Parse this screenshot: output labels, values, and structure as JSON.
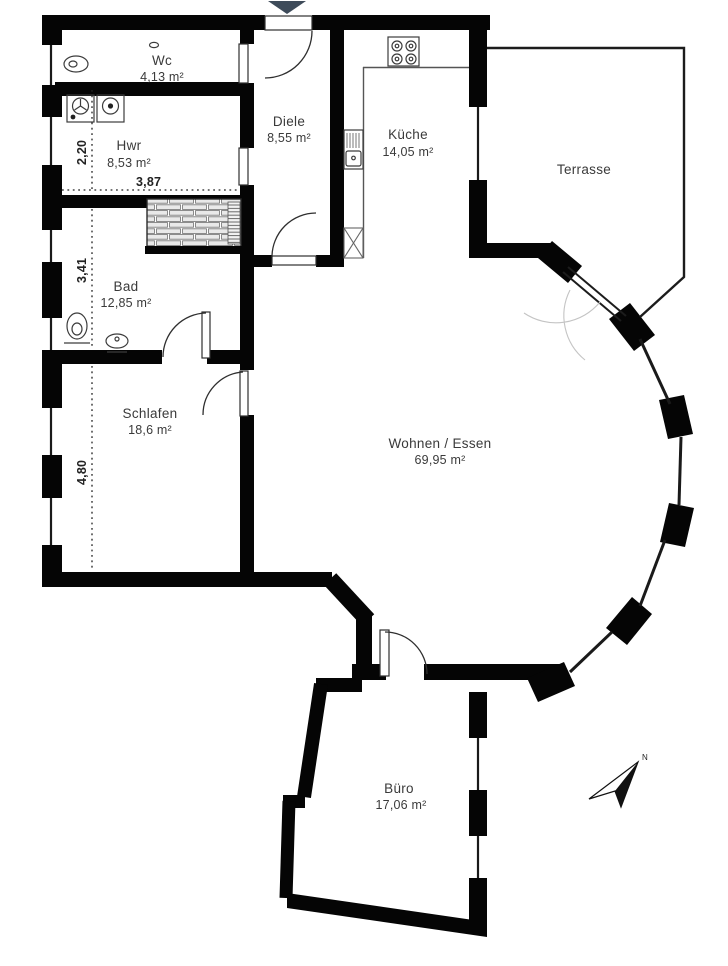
{
  "plan": {
    "title": "Wohnung Grundriss",
    "rooms": [
      {
        "id": "wc",
        "name": "Wc",
        "area": "4,13 m²"
      },
      {
        "id": "hwr",
        "name": "Hwr",
        "area": "8,53 m²"
      },
      {
        "id": "diele",
        "name": "Diele",
        "area": "8,55 m²"
      },
      {
        "id": "kueche",
        "name": "Küche",
        "area": "14,05 m²"
      },
      {
        "id": "terrasse",
        "name": "Terrasse",
        "area": ""
      },
      {
        "id": "bad",
        "name": "Bad",
        "area": "12,85 m²"
      },
      {
        "id": "schlafen",
        "name": "Schlafen",
        "area": "18,6 m²"
      },
      {
        "id": "wohnen",
        "name": "Wohnen / Essen",
        "area": "69,95 m²"
      },
      {
        "id": "buero",
        "name": "Büro",
        "area": "17,06 m²"
      }
    ],
    "dimensions": {
      "hwr_height": "2,20",
      "hwr_width": "3,87",
      "bad_height": "3,41",
      "schlafen_height": "4,80"
    },
    "north": {
      "label": "N"
    },
    "colors": {
      "wall": "#050505",
      "entrance_marker": "#3E4B5A"
    }
  }
}
